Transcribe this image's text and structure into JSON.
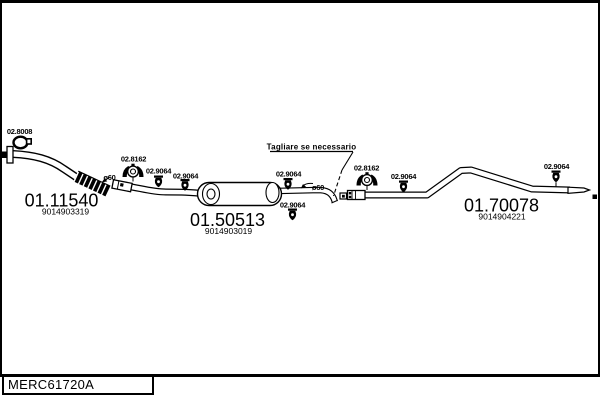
{
  "colors": {
    "ink": "#000000",
    "background": "#ffffff"
  },
  "footer": {
    "catalog_code": "MERC61720A"
  },
  "note": {
    "cut_label": "Tagliare se necessario"
  },
  "labels": {
    "gasket": "02.8008",
    "clamp": "02.8162",
    "hanger": "02.9064",
    "diameter": "ø60"
  },
  "parts": [
    {
      "code": "01.11540",
      "ref": "9014903319"
    },
    {
      "code": "01.50513",
      "ref": "9014903019"
    },
    {
      "code": "01.70078",
      "ref": "9014904221"
    }
  ]
}
